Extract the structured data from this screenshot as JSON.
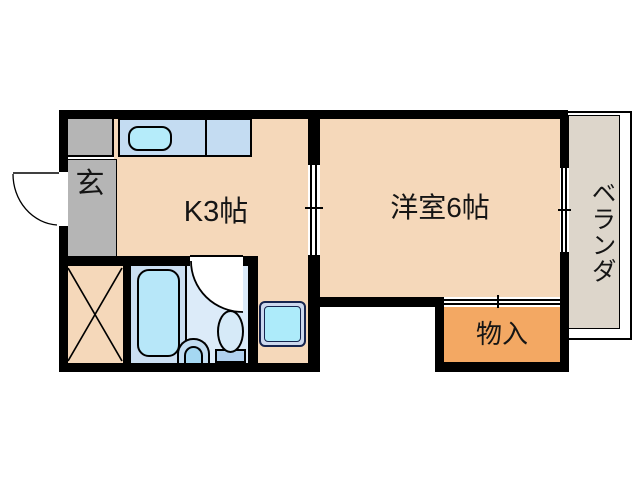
{
  "floorplan": {
    "type": "japanese-apartment-floor-plan",
    "labels": {
      "entrance": "玄",
      "kitchen": "K3帖",
      "western_room": "洋室6帖",
      "storage": "物入",
      "veranda": "ベランダ"
    },
    "colors": {
      "wall": "#000000",
      "floor_peach": "#f5d8ba",
      "entrance_gray": "#b5b5b5",
      "counter_blue": "#c4dcf2",
      "sink_cyan": "#b5ecfa",
      "bath_floor": "#cbdff2",
      "wc_floor": "#dcebf9",
      "bathtub_fill": "#b7e7f9",
      "toilet_bowl": "#d6eaf8",
      "toilet_tank": "#b0d0ee",
      "basin_outer": "#c2ddf1",
      "basin_inner": "#a5d8f2",
      "pan_ring": "#ccd8ee",
      "pan_inner": "#adebfa",
      "pan_border": "#16244e",
      "storage_orange": "#f3a863",
      "veranda_gray": "#ddd6cb"
    },
    "icons": {
      "kitchen-sink-icon": "rounded-rect",
      "bathtub-icon": "rounded-rect",
      "washbasin-icon": "half-oval",
      "toilet-icon": "oval-with-tank",
      "washing-machine-pan-icon": "nested-rounded-squares",
      "entrance-door-swing-icon": "quarter-arc",
      "wc-door-swing-icon": "quarter-arc",
      "crossed-box-icon": "x-crossed-rect",
      "sliding-door-icon": "double-line-with-tick",
      "window-icon": "double-line-with-tick"
    }
  }
}
